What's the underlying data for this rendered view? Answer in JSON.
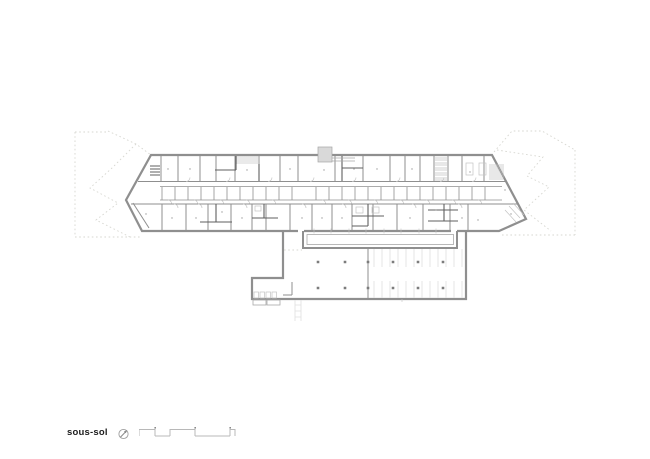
{
  "footer": {
    "floor_label": "sous-sol",
    "icons": [
      {
        "name": "north-arrow-icon"
      },
      {
        "name": "scale-bar"
      }
    ]
  },
  "colors": {
    "background": "#ffffff",
    "wall": "#8f8f8f",
    "wall_dark": "#5f5f5f",
    "detail": "#c3c3c3",
    "site_line": "#d7d7d1",
    "stall": "#e0e0e0",
    "fill_block": "#d9d9d9",
    "text": "#1c1c1c"
  }
}
